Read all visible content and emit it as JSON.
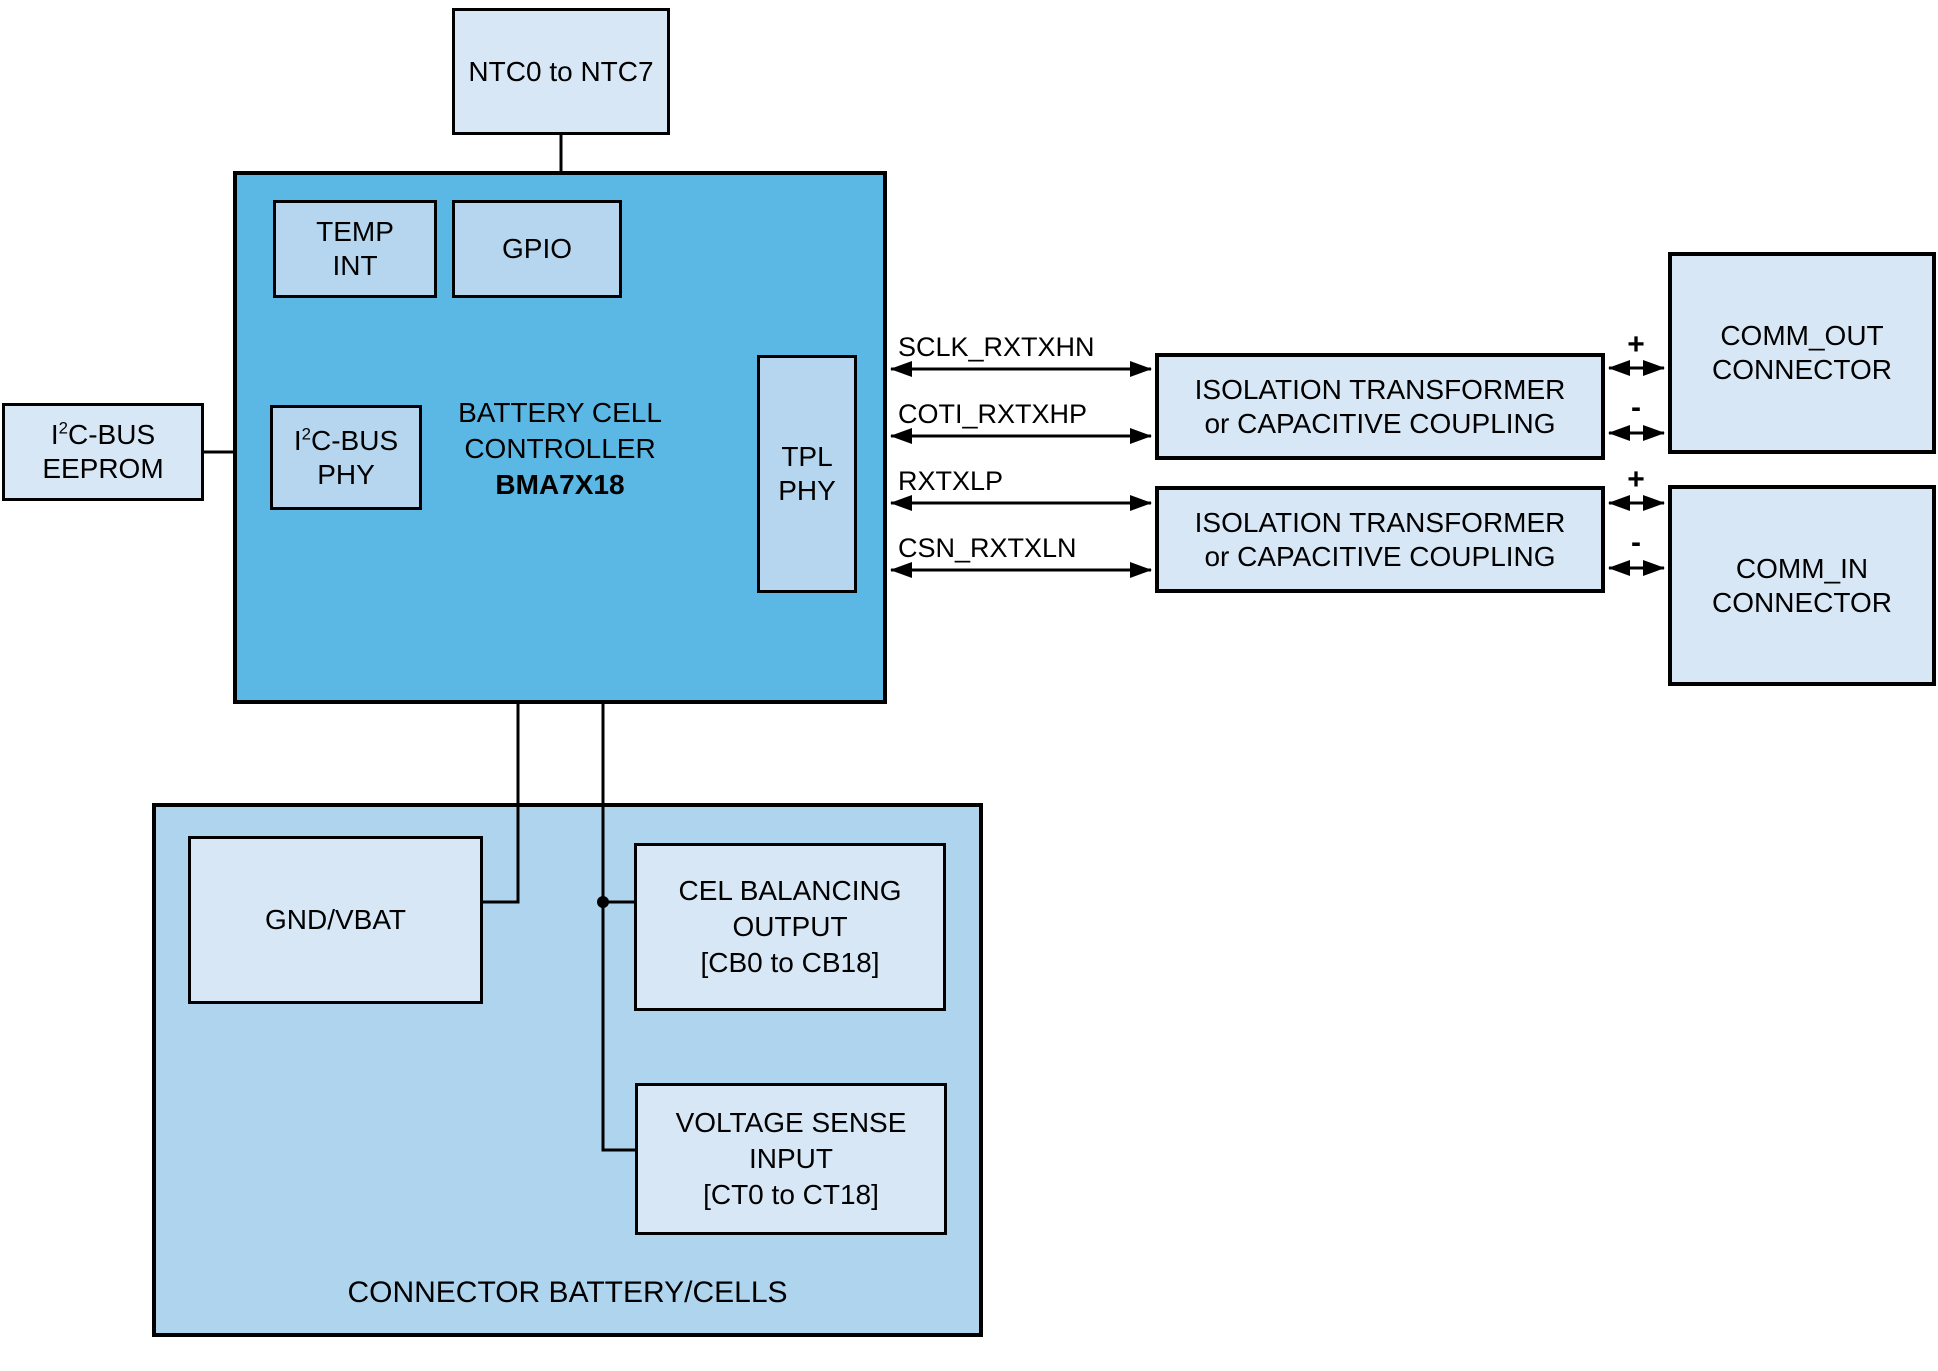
{
  "diagram": {
    "ntc": {
      "label": "NTC0 to NTC7"
    },
    "controller": {
      "temp_int": {
        "line1": "TEMP",
        "line2": "INT"
      },
      "gpio": {
        "label": "GPIO"
      },
      "i2c_phy": {
        "pre": "I",
        "sup": "2",
        "post": "C-BUS",
        "line2": "PHY"
      },
      "tpl_phy": {
        "line1": "TPL",
        "line2": "PHY"
      },
      "title": {
        "line1": "BATTERY CELL",
        "line2": "CONTROLLER",
        "line3": "BMA7X18"
      }
    },
    "eeprom": {
      "pre": "I",
      "sup": "2",
      "post": "C-BUS",
      "line2": "EEPROM"
    },
    "signals": [
      "SCLK_RXTXHN",
      "COTI_RXTXHP",
      "RXTXLP",
      "CSN_RXTXLN"
    ],
    "isolation1": {
      "line1": "ISOLATION TRANSFORMER",
      "line2": "or CAPACITIVE COUPLING"
    },
    "isolation2": {
      "line1": "ISOLATION TRANSFORMER",
      "line2": "or CAPACITIVE COUPLING"
    },
    "comm_out": {
      "line1": "COMM_OUT",
      "line2": "CONNECTOR"
    },
    "comm_in": {
      "line1": "COMM_IN",
      "line2": "CONNECTOR"
    },
    "plus": "+",
    "minus": "-",
    "battery": {
      "gnd_vbat": {
        "label": "GND/VBAT"
      },
      "cell_balancing": {
        "line1": "CEL BALANCING",
        "line2": "OUTPUT",
        "line3": "[CB0 to CB18]"
      },
      "voltage_sense": {
        "line1": "VOLTAGE SENSE",
        "line2": "INPUT",
        "line3": "[CT0 to CT18]"
      },
      "label": "CONNECTOR BATTERY/CELLS"
    },
    "colors": {
      "controller_fill": "#5bb7e3",
      "battery_connector_fill": "#afd4ee",
      "controller_subblock_fill": "#b5d6ee",
      "peripheral_fill": "#d8e7f5",
      "line": "#000000"
    }
  }
}
